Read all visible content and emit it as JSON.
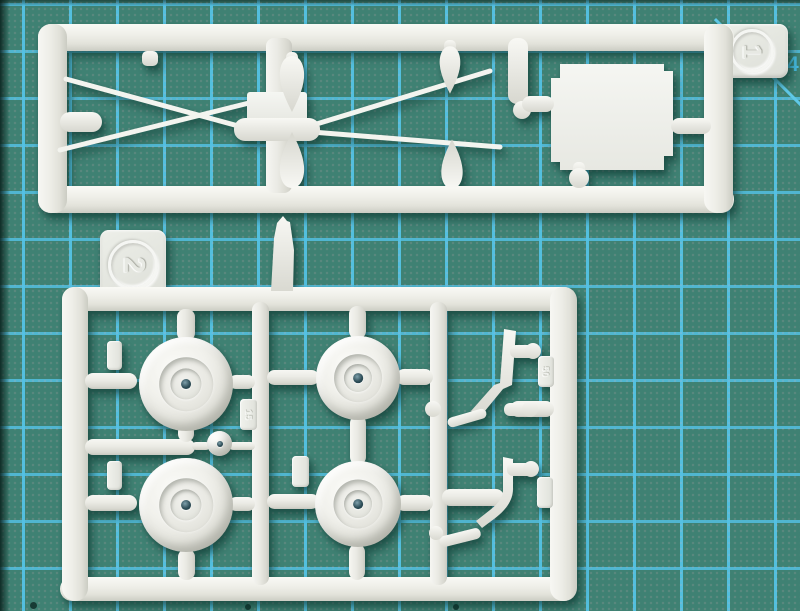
{
  "scene": {
    "description": "Top-down macro photo of two white polystyrene model-kit sprues (part runners) lying on a teal self-healing cutting mat with cyan grid lines",
    "subject": "plastic model kit sprues",
    "surface": "green cutting mat with grid"
  },
  "mat": {
    "base_color": "#3f8173",
    "grid_line_color": "#54c2e4",
    "grid_spacing_px": 47,
    "corner_number": "4",
    "corner_number_color": "#49c0e6",
    "edge_marks": "dark edge top-left, diagonal 45-degree guide line top-right, small dark dots along bottom edge"
  },
  "plastic": {
    "base_color": "#efefea",
    "highlight_color": "#f8f8f4",
    "shade_color": "#cfcfc7"
  },
  "sprue1": {
    "tag_label": "1",
    "tag_shape": "rounded square with embossed circled numeral, rotated 90 degrees",
    "contents": [
      "crossed thin rigging rods",
      "four teardrop fairing parts",
      "central hub runner with flat molding pad",
      "large flat plate part with stepped corners"
    ]
  },
  "sprue2": {
    "tag_label": "2",
    "part_number_labels": {
      "wheel_tag": "15",
      "skid_tag": "50"
    },
    "contents": [
      "four treadless road wheels with recessed hubs",
      "small idler disc",
      "two bent landing-skid struts with foot pads",
      "tapered step blade above top rail",
      "several blank embossed part-number tags"
    ]
  }
}
